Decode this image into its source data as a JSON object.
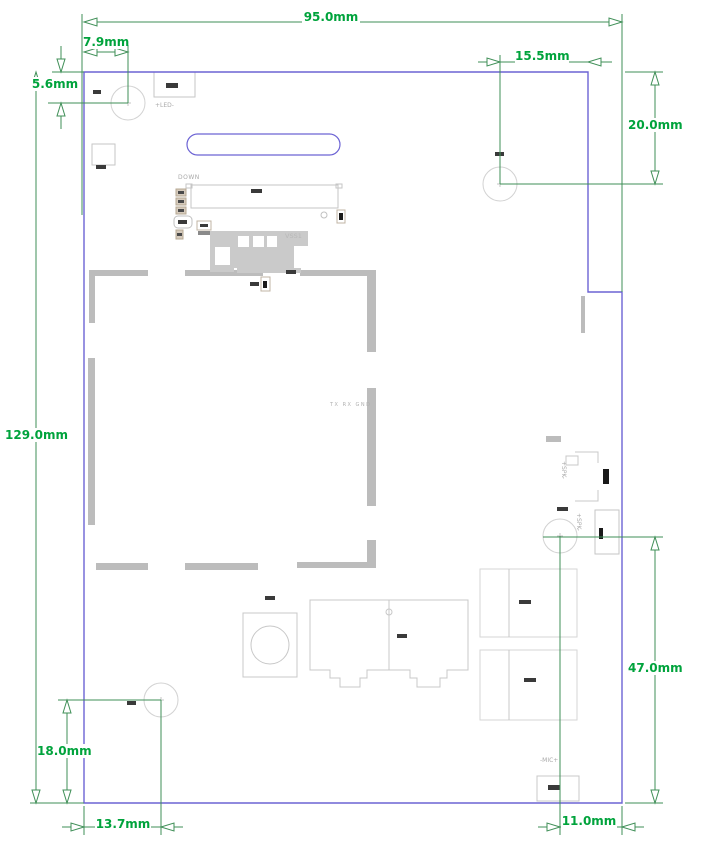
{
  "drawing": {
    "type": "pcb-dimension-drawing",
    "units": "mm",
    "board": {
      "width_mm": 95.0,
      "height_mm": 129.0
    },
    "colors": {
      "dimension_text": "#00a33c",
      "dimension_line": "#3f8f57",
      "board_outline": "#6c63d4",
      "silkscreen": "#a9a9a9",
      "shield_frame": "#bcbcbc"
    },
    "dims": {
      "d95": {
        "label": "95.0mm",
        "value": 95.0,
        "orientation": "horizontal"
      },
      "d7_9": {
        "label": "7.9mm",
        "value": 7.9,
        "orientation": "horizontal"
      },
      "d5_6": {
        "label": "5.6mm",
        "value": 5.6,
        "orientation": "vertical"
      },
      "d15_5": {
        "label": "15.5mm",
        "value": 15.5,
        "orientation": "horizontal"
      },
      "d20": {
        "label": "20.0mm",
        "value": 20.0,
        "orientation": "vertical"
      },
      "d129": {
        "label": "129.0mm",
        "value": 129.0,
        "orientation": "vertical"
      },
      "d47": {
        "label": "47.0mm",
        "value": 47.0,
        "orientation": "vertical"
      },
      "d18": {
        "label": "18.0mm",
        "value": 18.0,
        "orientation": "vertical"
      },
      "d13_7": {
        "label": "13.7mm",
        "value": 13.7,
        "orientation": "horizontal"
      },
      "d11": {
        "label": "11.0mm",
        "value": 11.0,
        "orientation": "horizontal"
      }
    },
    "silk": {
      "down": "DOWN",
      "led": "+LED-",
      "vss1": "VSS1",
      "uart": "TX RX GND",
      "spk_conn": "+SPK-",
      "spk_pad": "+SPK-",
      "mic": "-MIC+"
    }
  }
}
